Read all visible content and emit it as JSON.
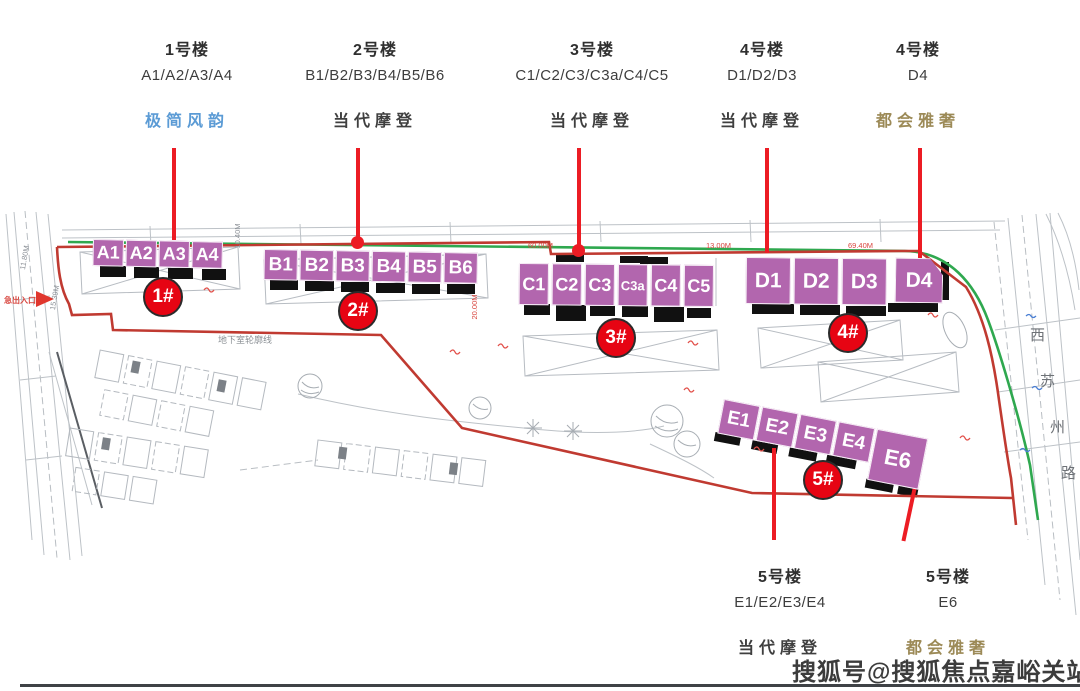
{
  "header": {
    "columns": [
      {
        "building": "1号楼",
        "units": "A1/A2/A3/A4",
        "style": "极简风韵",
        "style_color": "#5b9bd5"
      },
      {
        "building": "2号楼",
        "units": "B1/B2/B3/B4/B5/B6",
        "style": "当代摩登",
        "style_color": "#3f3f3f"
      },
      {
        "building": "3号楼",
        "units": "C1/C2/C3/C3a/C4/C5",
        "style": "当代摩登",
        "style_color": "#3f3f3f"
      },
      {
        "building": "4号楼",
        "units": "D1/D2/D3",
        "style": "当代摩登",
        "style_color": "#3f3f3f"
      },
      {
        "building": "4号楼",
        "units": "D4",
        "style": "都会雅奢",
        "style_color": "#9c8a57"
      }
    ]
  },
  "footer": {
    "columns": [
      {
        "building": "5号楼",
        "units": "E1/E2/E3/E4",
        "style": "当代摩登",
        "style_color": "#3f3f3f"
      },
      {
        "building": "5号楼",
        "units": "E6",
        "style": "都会雅奢",
        "style_color": "#9c8a57"
      }
    ]
  },
  "site": {
    "rows": [
      {
        "badge": "1#",
        "blocks": [
          "A1",
          "A2",
          "A3",
          "A4"
        ]
      },
      {
        "badge": "2#",
        "blocks": [
          "B1",
          "B2",
          "B3",
          "B4",
          "B5",
          "B6"
        ]
      },
      {
        "badge": "3#",
        "blocks": [
          "C1",
          "C2",
          "C3",
          "C3a",
          "C4",
          "C5"
        ]
      },
      {
        "badge": "4#",
        "blocks": [
          "D1",
          "D2",
          "D3",
          "D4"
        ]
      },
      {
        "badge": "5#",
        "blocks": [
          "E1",
          "E2",
          "E3",
          "E4",
          "E6"
        ]
      }
    ],
    "colors": {
      "block": "#b266ae",
      "badge": "#e60413",
      "leader": "#ec1c24",
      "boundary": "#c03a31",
      "green_line": "#2fa84f"
    }
  },
  "plan": {
    "entrance_label": "急出入口",
    "underground_label": "地下室轮廓线",
    "road_name": "西苏州路",
    "road_name_chars": [
      "西",
      "苏",
      "州",
      "路"
    ],
    "dims": {
      "top1": "60.00M",
      "top2": "13.00M",
      "top3": "69.40M",
      "v1": "13.00M",
      "v2": "20.00M",
      "left1": "11.80M",
      "left2": "15.39M",
      "mid1": "10.40M"
    }
  },
  "watermark": "搜狐号@搜狐焦点嘉峪关站"
}
